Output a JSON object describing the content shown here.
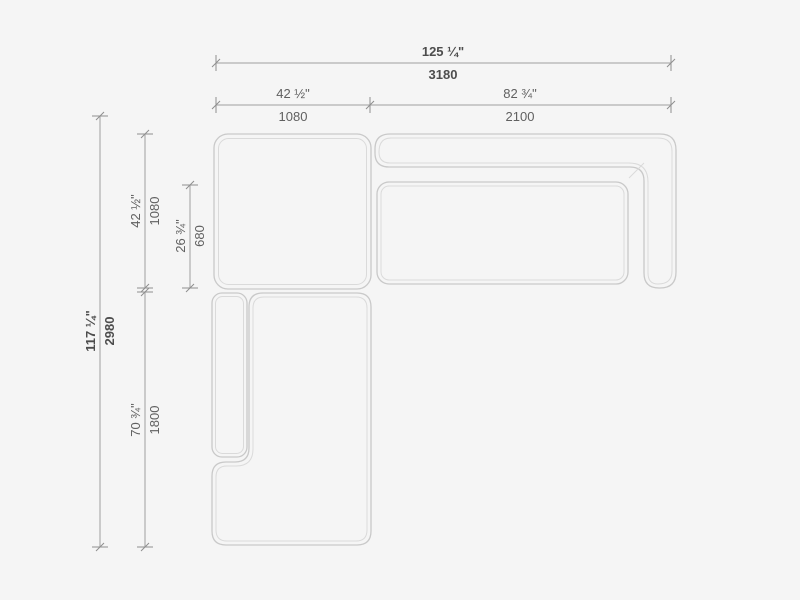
{
  "colors": {
    "background": "#f5f5f5",
    "sofa_outline": "#c9c9c9",
    "sofa_inner_line": "#dadada",
    "dimension_line": "#a0a0a0",
    "tick_mark": "#8f8f8f",
    "dimension_text": "#606060",
    "dimension_text_bold": "#4d4d4d"
  },
  "dims": {
    "overall_width": {
      "inches": "125 ¼\"",
      "mm": "3180"
    },
    "left_section_width": {
      "inches": "42 ½\"",
      "mm": "1080"
    },
    "right_section_width": {
      "inches": "82 ¾\"",
      "mm": "2100"
    },
    "overall_depth": {
      "inches": "117 ¼\"",
      "mm": "2980"
    },
    "top_section_depth": {
      "inches": "42 ½\"",
      "mm": "1080"
    },
    "seat_depth": {
      "inches": "26 ¾\"",
      "mm": "680"
    },
    "chaise_length": {
      "inches": "70 ¾\"",
      "mm": "1800"
    }
  }
}
